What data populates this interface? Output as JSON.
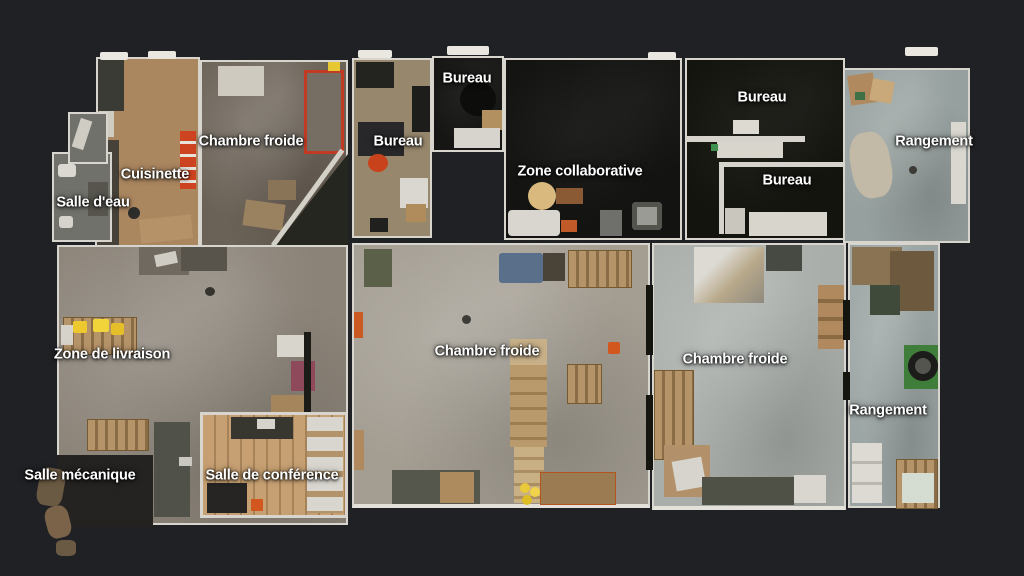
{
  "floorplan": {
    "background": "#202124",
    "wall_color": "#d8d5ce",
    "label_text_color": "#ffffff",
    "rooms": [
      {
        "id": "cuisinette",
        "name": "Cuisinette",
        "floor_color": "#ab8760"
      },
      {
        "id": "salle-deau",
        "name": "Salle d'eau",
        "floor_color": "#71716b"
      },
      {
        "id": "chambre-froide-1",
        "name": "Chambre froide",
        "floor_color": "#6b6257"
      },
      {
        "id": "bureau-nord",
        "name": "Bureau",
        "floor_color": "#97876d"
      },
      {
        "id": "bureau-petit",
        "name": "Bureau",
        "floor_color": "#161614"
      },
      {
        "id": "zone-collaborative",
        "name": "Zone collaborative",
        "floor_color": "#131312"
      },
      {
        "id": "bureaux-est",
        "name": "Bureau",
        "floor_color": "#14140f"
      },
      {
        "id": "rangement-nord",
        "name": "Rangement",
        "floor_color": "#96a09e"
      },
      {
        "id": "zone-de-livraison",
        "name": "Zone de livraison",
        "floor_color": "#8b8378"
      },
      {
        "id": "salle-mecanique",
        "name": "Salle mécanique",
        "floor_color": "#242321"
      },
      {
        "id": "salle-de-conference",
        "name": "Salle de conférence",
        "floor_color": "#c6a072"
      },
      {
        "id": "chambre-froide-2",
        "name": "Chambre froide",
        "floor_color": "#a39d92"
      },
      {
        "id": "chambre-froide-3",
        "name": "Chambre froide",
        "floor_color": "#a9aeaa"
      },
      {
        "id": "rangement-sud",
        "name": "Rangement",
        "floor_color": "#9aa4a2"
      }
    ],
    "labels": [
      {
        "id": "bureau-petit",
        "text": "Bureau",
        "x": 467,
        "y": 78
      },
      {
        "id": "bureau-est-1",
        "text": "Bureau",
        "x": 762,
        "y": 97
      },
      {
        "id": "chambre-froide-1",
        "text": "Chambre froide",
        "x": 251,
        "y": 141
      },
      {
        "id": "bureau-nord",
        "text": "Bureau",
        "x": 398,
        "y": 141
      },
      {
        "id": "rangement-nord",
        "text": "Rangement",
        "x": 934,
        "y": 141
      },
      {
        "id": "zone-collaborative",
        "text": "Zone collaborative",
        "x": 580,
        "y": 171
      },
      {
        "id": "cuisinette",
        "text": "Cuisinette",
        "x": 155,
        "y": 174
      },
      {
        "id": "bureau-est-2",
        "text": "Bureau",
        "x": 787,
        "y": 180
      },
      {
        "id": "salle-deau",
        "text": "Salle d'eau",
        "x": 93,
        "y": 202
      },
      {
        "id": "chambre-froide-2",
        "text": "Chambre froide",
        "x": 487,
        "y": 351
      },
      {
        "id": "zone-de-livraison",
        "text": "Zone de livraison",
        "x": 112,
        "y": 354
      },
      {
        "id": "chambre-froide-3",
        "text": "Chambre froide",
        "x": 735,
        "y": 359
      },
      {
        "id": "rangement-sud",
        "text": "Rangement",
        "x": 888,
        "y": 410
      },
      {
        "id": "salle-mecanique",
        "text": "Salle mécanique",
        "x": 80,
        "y": 475
      },
      {
        "id": "salle-de-conference",
        "text": "Salle de conférence",
        "x": 272,
        "y": 475
      }
    ]
  }
}
